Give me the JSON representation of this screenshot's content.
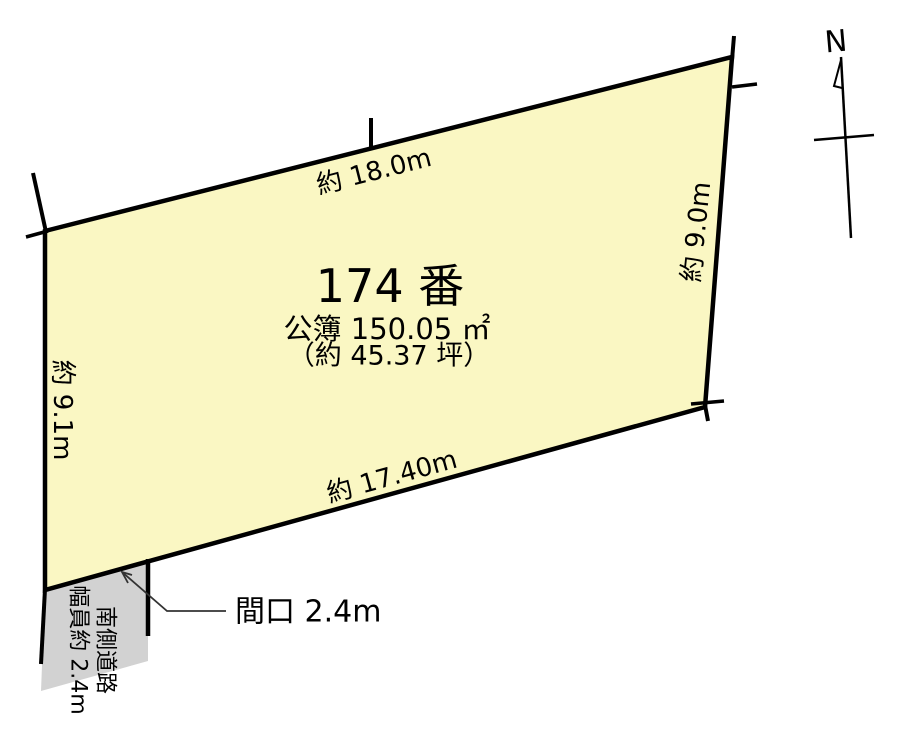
{
  "diagram": {
    "lot": {
      "number": "174 番",
      "area_registered": "公簿 150.05 ㎡",
      "area_tsubo": "（約 45.37 坪）"
    },
    "edges": {
      "top": "約 18.0m",
      "right": "約 9.0m",
      "left": "約 9.1m",
      "bottom": "約 17.40m"
    },
    "road": {
      "label_line1": "南側道路",
      "label_line2": "幅員約 2.4m"
    },
    "frontage": {
      "label": "間口 2.4m"
    },
    "compass": {
      "label": "N"
    },
    "colors": {
      "parcel_fill": "#faf7c3",
      "road_fill": "#d2d2d2",
      "line": "#000000",
      "leader": "#333333"
    }
  }
}
